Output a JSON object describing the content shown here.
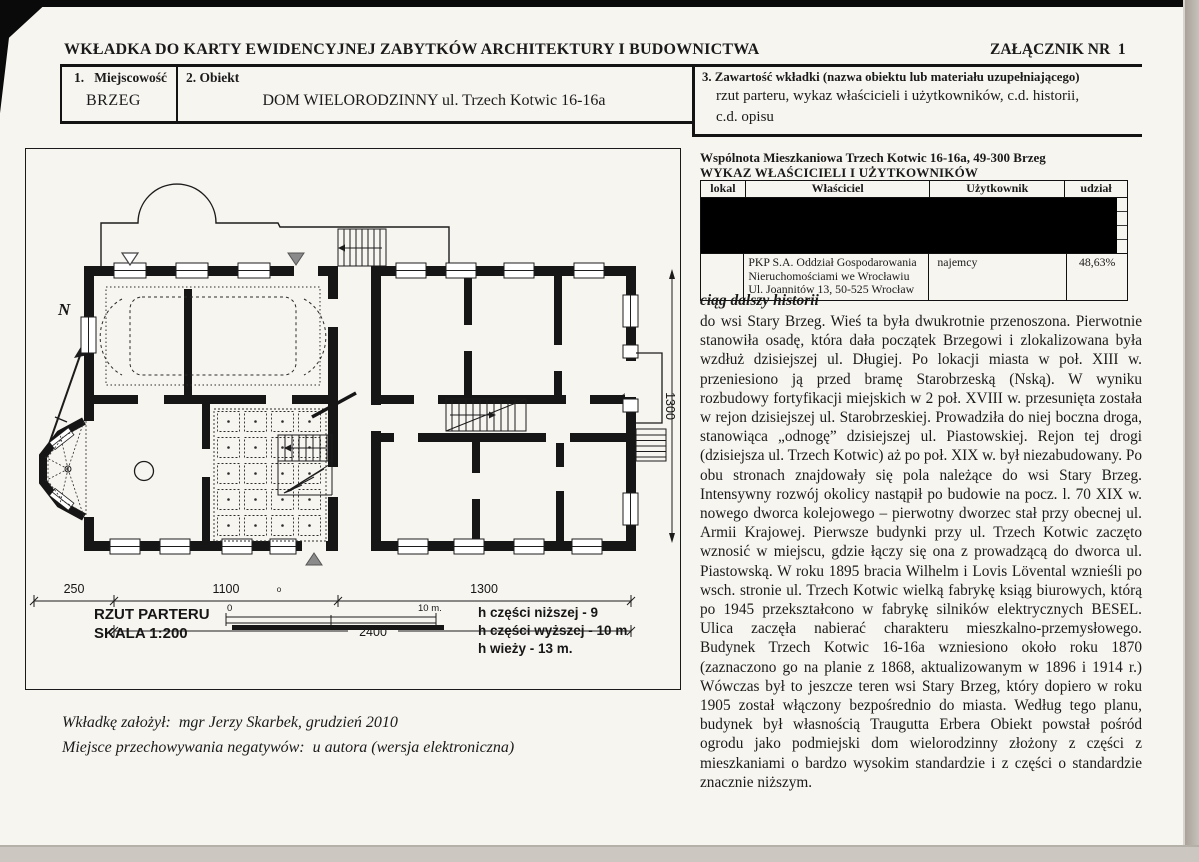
{
  "header": {
    "title": "WKŁADKA DO KARTY EWIDENCYJNEJ ZABYTKÓW ARCHITEKTURY I BUDOWNICTWA",
    "attachment": "ZAŁĄCZNIK NR  1"
  },
  "fields": {
    "f1_label": "1.   Miejscowość",
    "f1_value": "BRZEG",
    "f2_label": "2. Obiekt",
    "f2_value": "DOM WIELORODZINNY ul. Trzech Kotwic 16-16a",
    "f3_label": "3. Zawartość wkładki (nazwa obiektu lub materiału uzupełniającego)",
    "f3_value_line1": "rzut parteru, wykaz właścicieli i użytkowników, c.d. historii,",
    "f3_value_line2": "c.d. opisu"
  },
  "owners": {
    "association_line": "Wspólnota Mieszkaniowa Trzech Kotwic 16-16a, 49-300 Brzeg",
    "list_title": "WYKAZ WŁAŚCICIELI I UŻYTKOWNIKÓW",
    "columns": [
      "lokal",
      "Właściciel",
      "Użytkownik",
      "udział"
    ],
    "last_row": {
      "owner": "PKP S.A. Oddział Gospodarowania Nieruchomościami we Wrocławiu Ul. Joannitów 13, 50-525 Wrocław",
      "user": "najemcy",
      "share": "48,63%"
    }
  },
  "history": {
    "heading": "ciąg dalszy historii",
    "body": "do wsi Stary Brzeg. Wieś ta była dwukrotnie przenoszona. Pierwotnie stanowiła osadę, która dała początek Brzegowi i zlokalizowana była wzdłuż dzisiejszej ul. Długiej. Po lokacji miasta w poł. XIII w. przeniesiono ją przed bramę Starobrzeską (Nską). W wyniku rozbudowy fortyfikacji miejskich w 2 poł. XVIII w. przesunięta została w rejon dzisiejszej ul. Starobrzeskiej. Prowadziła do niej boczna droga, stanowiąca „odnogę” dzisiejszej ul. Piastowskiej. Rejon tej drogi (dzisiejsza ul. Trzech Kotwic) aż po poł. XIX w. był niezabudowany. Po obu stronach znajdowały się pola należące do wsi Stary Brzeg. Intensywny rozwój okolicy nastąpił po budowie na pocz. l. 70 XIX w. nowego dworca kolejowego – pierwotny dworzec stał przy obecnej ul. Armii Krajowej. Pierwsze budynki przy ul. Trzech Kotwic zaczęto wznosić w miejscu, gdzie łączy się ona z prowadzącą do dworca ul. Piastowską. W roku 1895 bracia Wilhelm i Lovis Lövental wznieśli po wsch. stronie ul. Trzech Kotwic wielką fabrykę ksiąg biurowych, którą po 1945 przekształcono w fabrykę silników elektrycznych BESEL. Ulica zaczęła nabierać charakteru mieszkalno-przemysłowego. Budynek Trzech Kotwic 16-16a wzniesiono około roku 1870 (zaznaczono go na planie z 1868, aktualizowanym w 1896 i 1914 r.) Wówczas był to jeszcze teren wsi Stary Brzeg, który dopiero w roku 1905 został włączony bezpośrednio do miasta. Według tego planu, budynek był własnością Traugutta Erbera Obiekt powstał pośród ogrodu jako podmiejski dom wielorodzinny złożony z części z mieszkaniami o bardzo wysokim standardzie i z części o standardzie znacznie niższym."
  },
  "plan": {
    "caption_line1": "RZUT PARTERU",
    "caption_line2": "SKALA 1:200",
    "scale_zero": "0",
    "scale_ten": "10 m.",
    "heights": [
      "h części niższej - 9",
      "h części wyższej - 10 m",
      "h wieży - 13 m."
    ],
    "compass_n": "N",
    "dim_250": "250",
    "dim_1100": "1100",
    "dim_1300_bottom": "1300",
    "dim_2400": "2400",
    "dim_1300_right": "1300",
    "degree_mark": "o"
  },
  "footer": {
    "line1": "Wkładkę założył:  mgr Jerzy Skarbek, grudzień 2010",
    "line2": "Miejsce przechowywania negatywów:  u autora (wersja elektroniczna)"
  }
}
